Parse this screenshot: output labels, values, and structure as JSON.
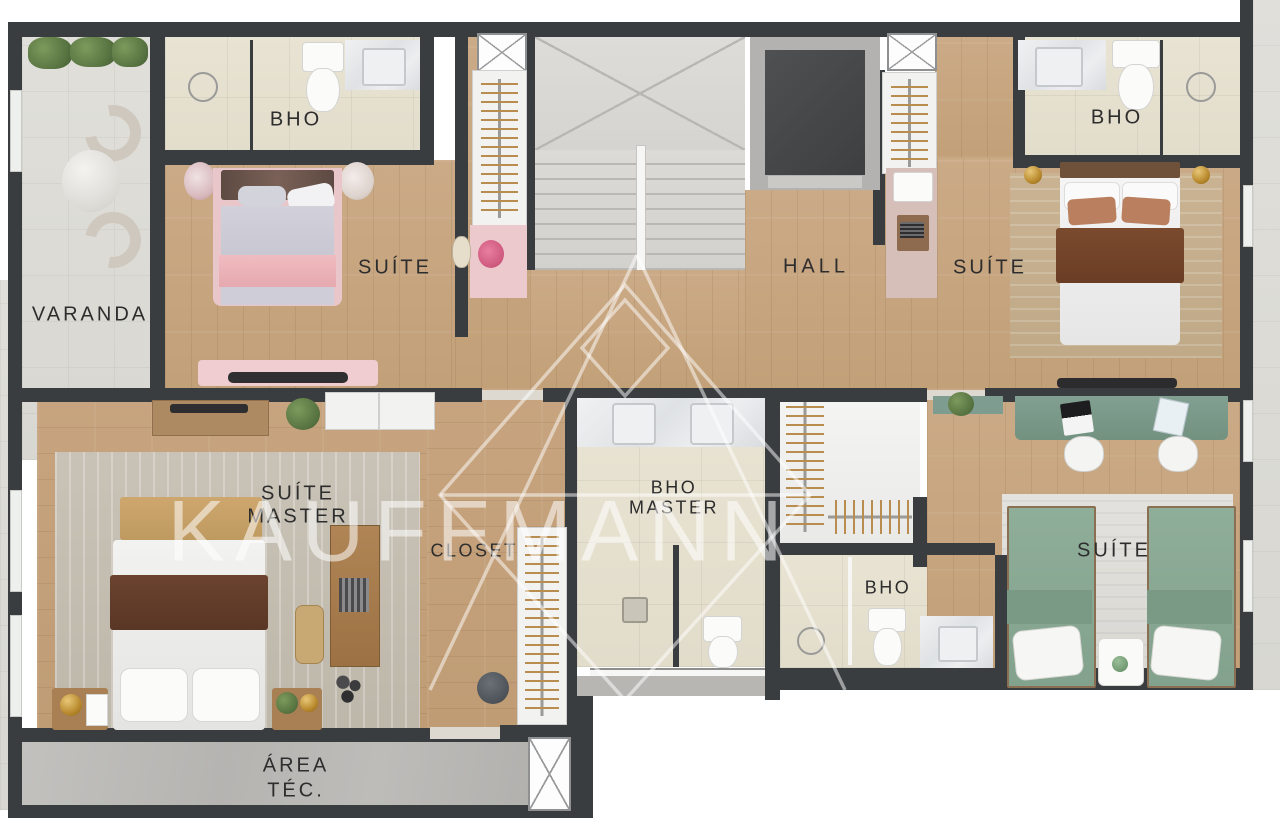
{
  "watermark": {
    "brand": "KAUFFMANN"
  },
  "rooms": {
    "varanda": {
      "label": "VARANDA"
    },
    "suite1_bathroom": {
      "label": "BHO"
    },
    "suite1": {
      "label": "SUÍTE"
    },
    "hall": {
      "label": "HALL"
    },
    "suite2": {
      "label": "SUÍTE"
    },
    "suite2_bathroom": {
      "label": "BHO"
    },
    "suite_master": {
      "label_line1": "SUÍTE",
      "label_line2": "MASTER"
    },
    "closet": {
      "label": "CLOSET"
    },
    "bho_master": {
      "label_line1": "BHO",
      "label_line2": "MASTER"
    },
    "bathroom_small": {
      "label": "BHO"
    },
    "suite3": {
      "label": "SUÍTE"
    },
    "area_tecnica": {
      "label_line1": "ÁREA",
      "label_line2": "TÉC."
    }
  },
  "palette": {
    "wall": "#3a3d3f",
    "wood_floor": "#c6a47f",
    "bathroom_tile": "#e6e0d0",
    "stairs": "#d8d6d2",
    "concrete": "#b9b8b5",
    "pink_accent": "#eac3c8",
    "brown_accent": "#6e4632",
    "green_accent": "#8aa893",
    "desk_green": "#7b998c",
    "gold_accent": "#b98a2e",
    "watermark_white": "rgba(255,255,255,0.55)"
  }
}
